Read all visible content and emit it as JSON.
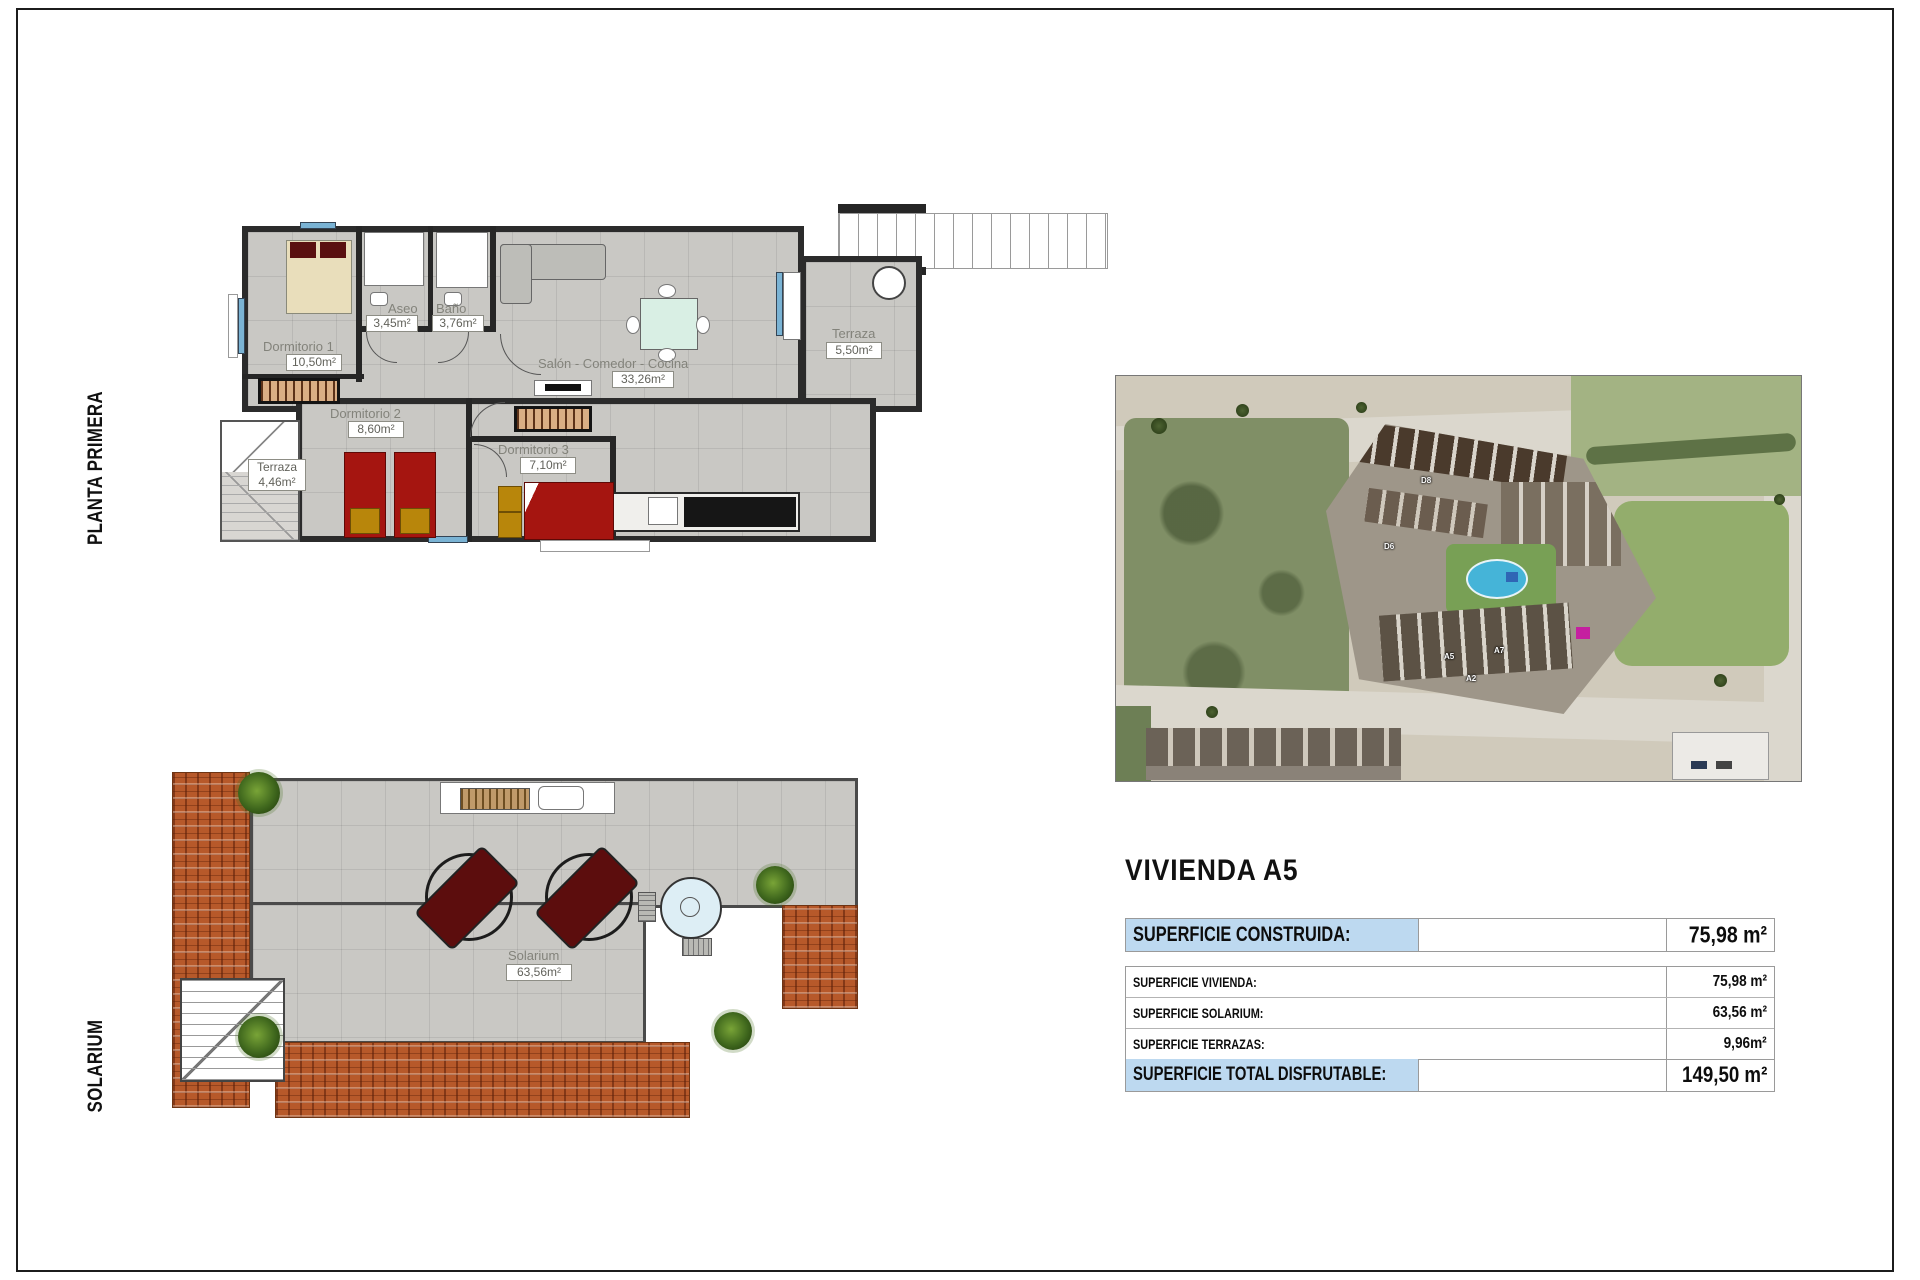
{
  "side_labels": {
    "planta_primera": "PLANTA PRIMERA",
    "solarium": "SOLARIUM"
  },
  "floor_plan": {
    "dormitorio1": {
      "name": "Dormitorio 1",
      "area": "10,50m²"
    },
    "aseo": {
      "name": "Aseo",
      "area": "3,45m²"
    },
    "bano": {
      "name": "Baño",
      "area": "3,76m²"
    },
    "salon": {
      "name": "Salón - Comedor - Cocina",
      "area": "33,26m²"
    },
    "dormitorio2": {
      "name": "Dormitorio 2",
      "area": "8,60m²"
    },
    "dormitorio3": {
      "name": "Dormitorio 3",
      "area": "7,10m²"
    },
    "terraza_izquierda": {
      "name": "Terraza",
      "area": "4,46m²"
    },
    "terraza_superior": {
      "name": "Terraza",
      "area": "5,50m²"
    }
  },
  "solarium_plan": {
    "name": "Solarium",
    "area": "63,56m²"
  },
  "site_map": {
    "unit_labels": [
      "D8",
      "D6",
      "A5",
      "A7",
      "A2"
    ]
  },
  "details": {
    "title": "VIVIENDA A5",
    "header": {
      "label": "SUPERFICIE CONSTRUIDA:",
      "value": "75,98 m²"
    },
    "rows": [
      {
        "label": "SUPERFICIE VIVIENDA:",
        "value": "75,98 m²"
      },
      {
        "label": "SUPERFICIE SOLARIUM:",
        "value": "63,56 m²"
      },
      {
        "label": "SUPERFICIE TERRAZAS:",
        "value": "9,96m²"
      }
    ],
    "total": {
      "label": "SUPERFICIE TOTAL DISFRUTABLE:",
      "value": "149,50 m²"
    }
  }
}
